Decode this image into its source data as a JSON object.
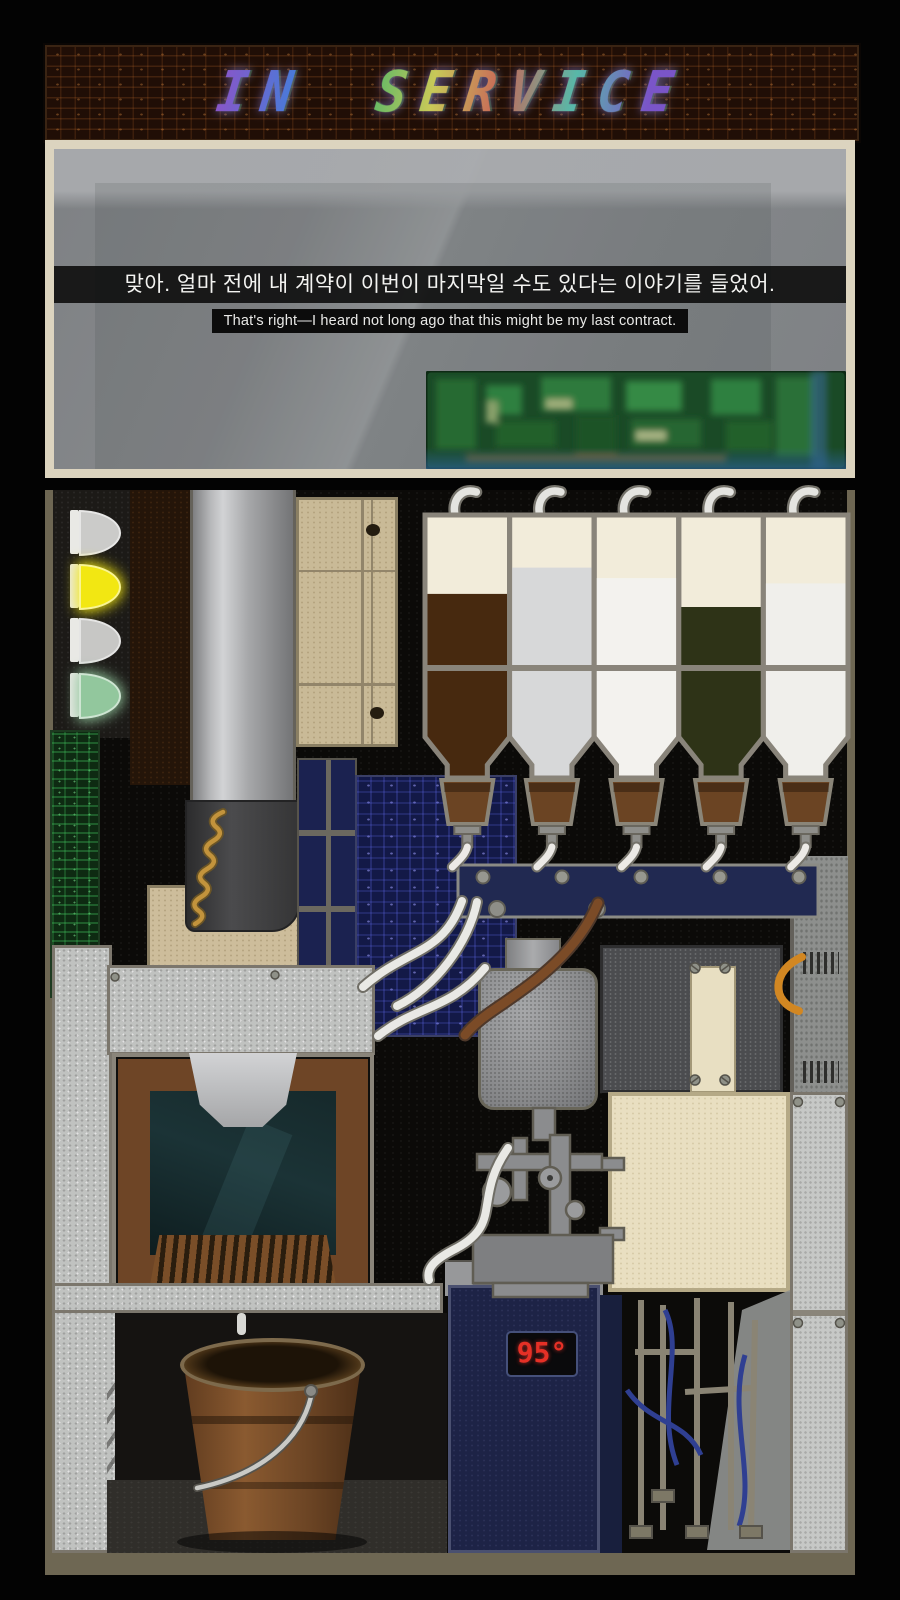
{
  "banner": {
    "title": "IN SERVICE"
  },
  "dialogue": {
    "korean": "맞아. 얼마 전에 내 계약이 이번이 마지막일 수도 있다는 이야기를 들었어.",
    "english": "That's right—I heard not long ago that this might be my last contract."
  },
  "status_lights": [
    {
      "name": "indicator-1",
      "color": "#cbcbc9",
      "lit": false
    },
    {
      "name": "indicator-2",
      "color": "#f2e712",
      "lit": true
    },
    {
      "name": "indicator-3",
      "color": "#c7c7c5",
      "lit": false
    },
    {
      "name": "indicator-4",
      "color": "#92c79d",
      "lit": true
    }
  ],
  "hoppers": [
    {
      "name": "hopper-coffee-grounds",
      "content": "dark roast grounds",
      "fill_color": "#47290f",
      "fill_level": 0.7
    },
    {
      "name": "hopper-milk-powder",
      "content": "milk powder",
      "fill_color": "#d7d8d9",
      "fill_level": 0.8
    },
    {
      "name": "hopper-sugar",
      "content": "sugar",
      "fill_color": "#f3f2ee",
      "fill_level": 0.76
    },
    {
      "name": "hopper-tea-leaves",
      "content": "green tea leaves",
      "fill_color": "#2e3317",
      "fill_level": 0.65
    },
    {
      "name": "hopper-creamer",
      "content": "creamer",
      "fill_color": "#f0efeb",
      "fill_level": 0.74
    }
  ],
  "boiler": {
    "temperature": "95°"
  },
  "colors": {
    "banner_bg": "#200e06",
    "dialog_border": "#dcd4bf",
    "manifold_navy": "#212951",
    "boiler_navy": "#1d2346",
    "temp_red": "#e63026",
    "pcb_green": "#1a4a26",
    "pcb_blue": "#131947",
    "frame_olive": "#6e6753"
  }
}
